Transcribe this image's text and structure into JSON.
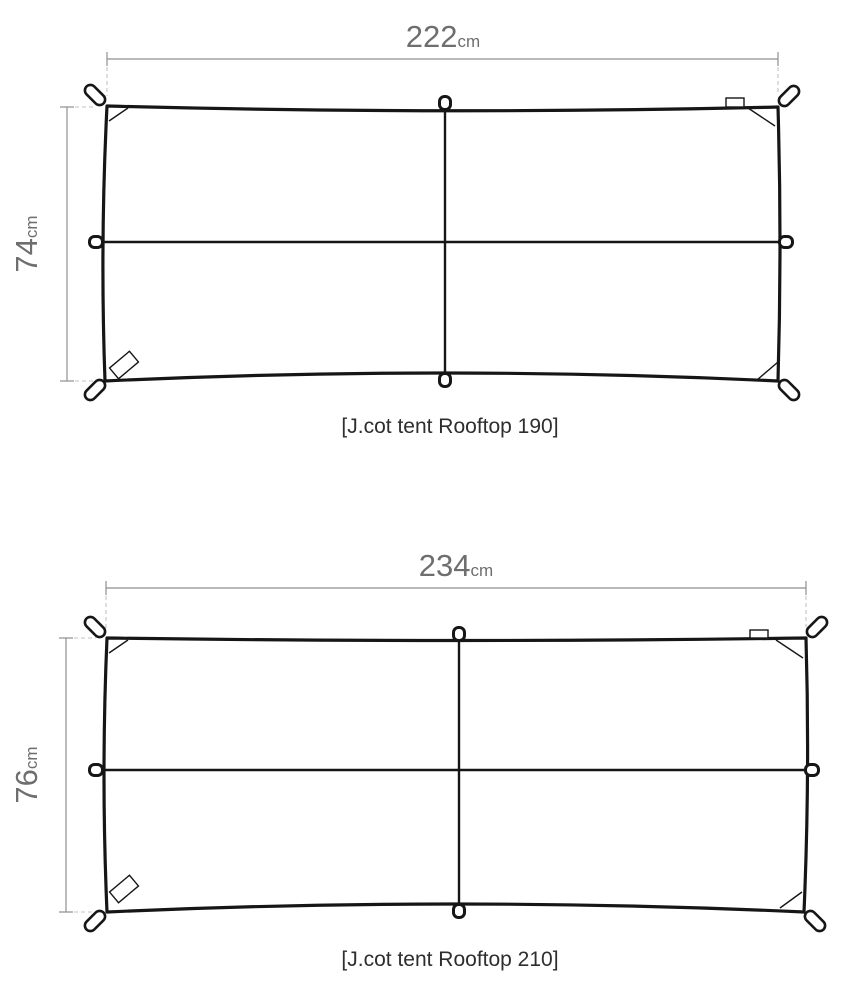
{
  "diagrams": [
    {
      "id": "rooftop-190",
      "caption": "[J.cot tent Rooftop 190]",
      "width": {
        "value": "222",
        "unit": "cm"
      },
      "height": {
        "value": "74",
        "unit": "cm"
      }
    },
    {
      "id": "rooftop-210",
      "caption": "[J.cot tent Rooftop 210]",
      "width": {
        "value": "234",
        "unit": "cm"
      },
      "height": {
        "value": "76",
        "unit": "cm"
      }
    }
  ],
  "colors": {
    "background": "#ffffff",
    "tarp_outline": "#161616",
    "dimension_line": "#8f8f8f",
    "extension_dash": "#c3c3c3",
    "dimension_text": "#6e6e6e",
    "caption_text": "#2e2e2e"
  }
}
